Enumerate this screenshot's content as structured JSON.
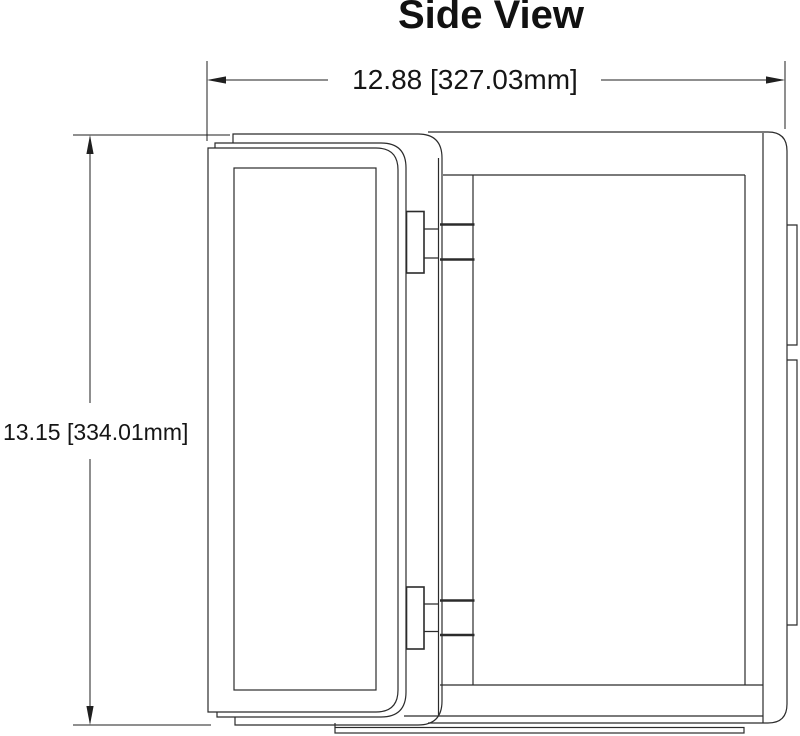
{
  "title": "Side View",
  "dimensions": {
    "width": {
      "label": "12.88 [327.03mm]",
      "inches": "12.88",
      "mm": "327.03"
    },
    "height": {
      "label": "13.15 [334.01mm]",
      "inches": "13.15",
      "mm": "334.01"
    }
  },
  "drawing": {
    "line_color": "#2b2b2b",
    "dim_color": "#1f1f1f",
    "background": "#ffffff"
  }
}
